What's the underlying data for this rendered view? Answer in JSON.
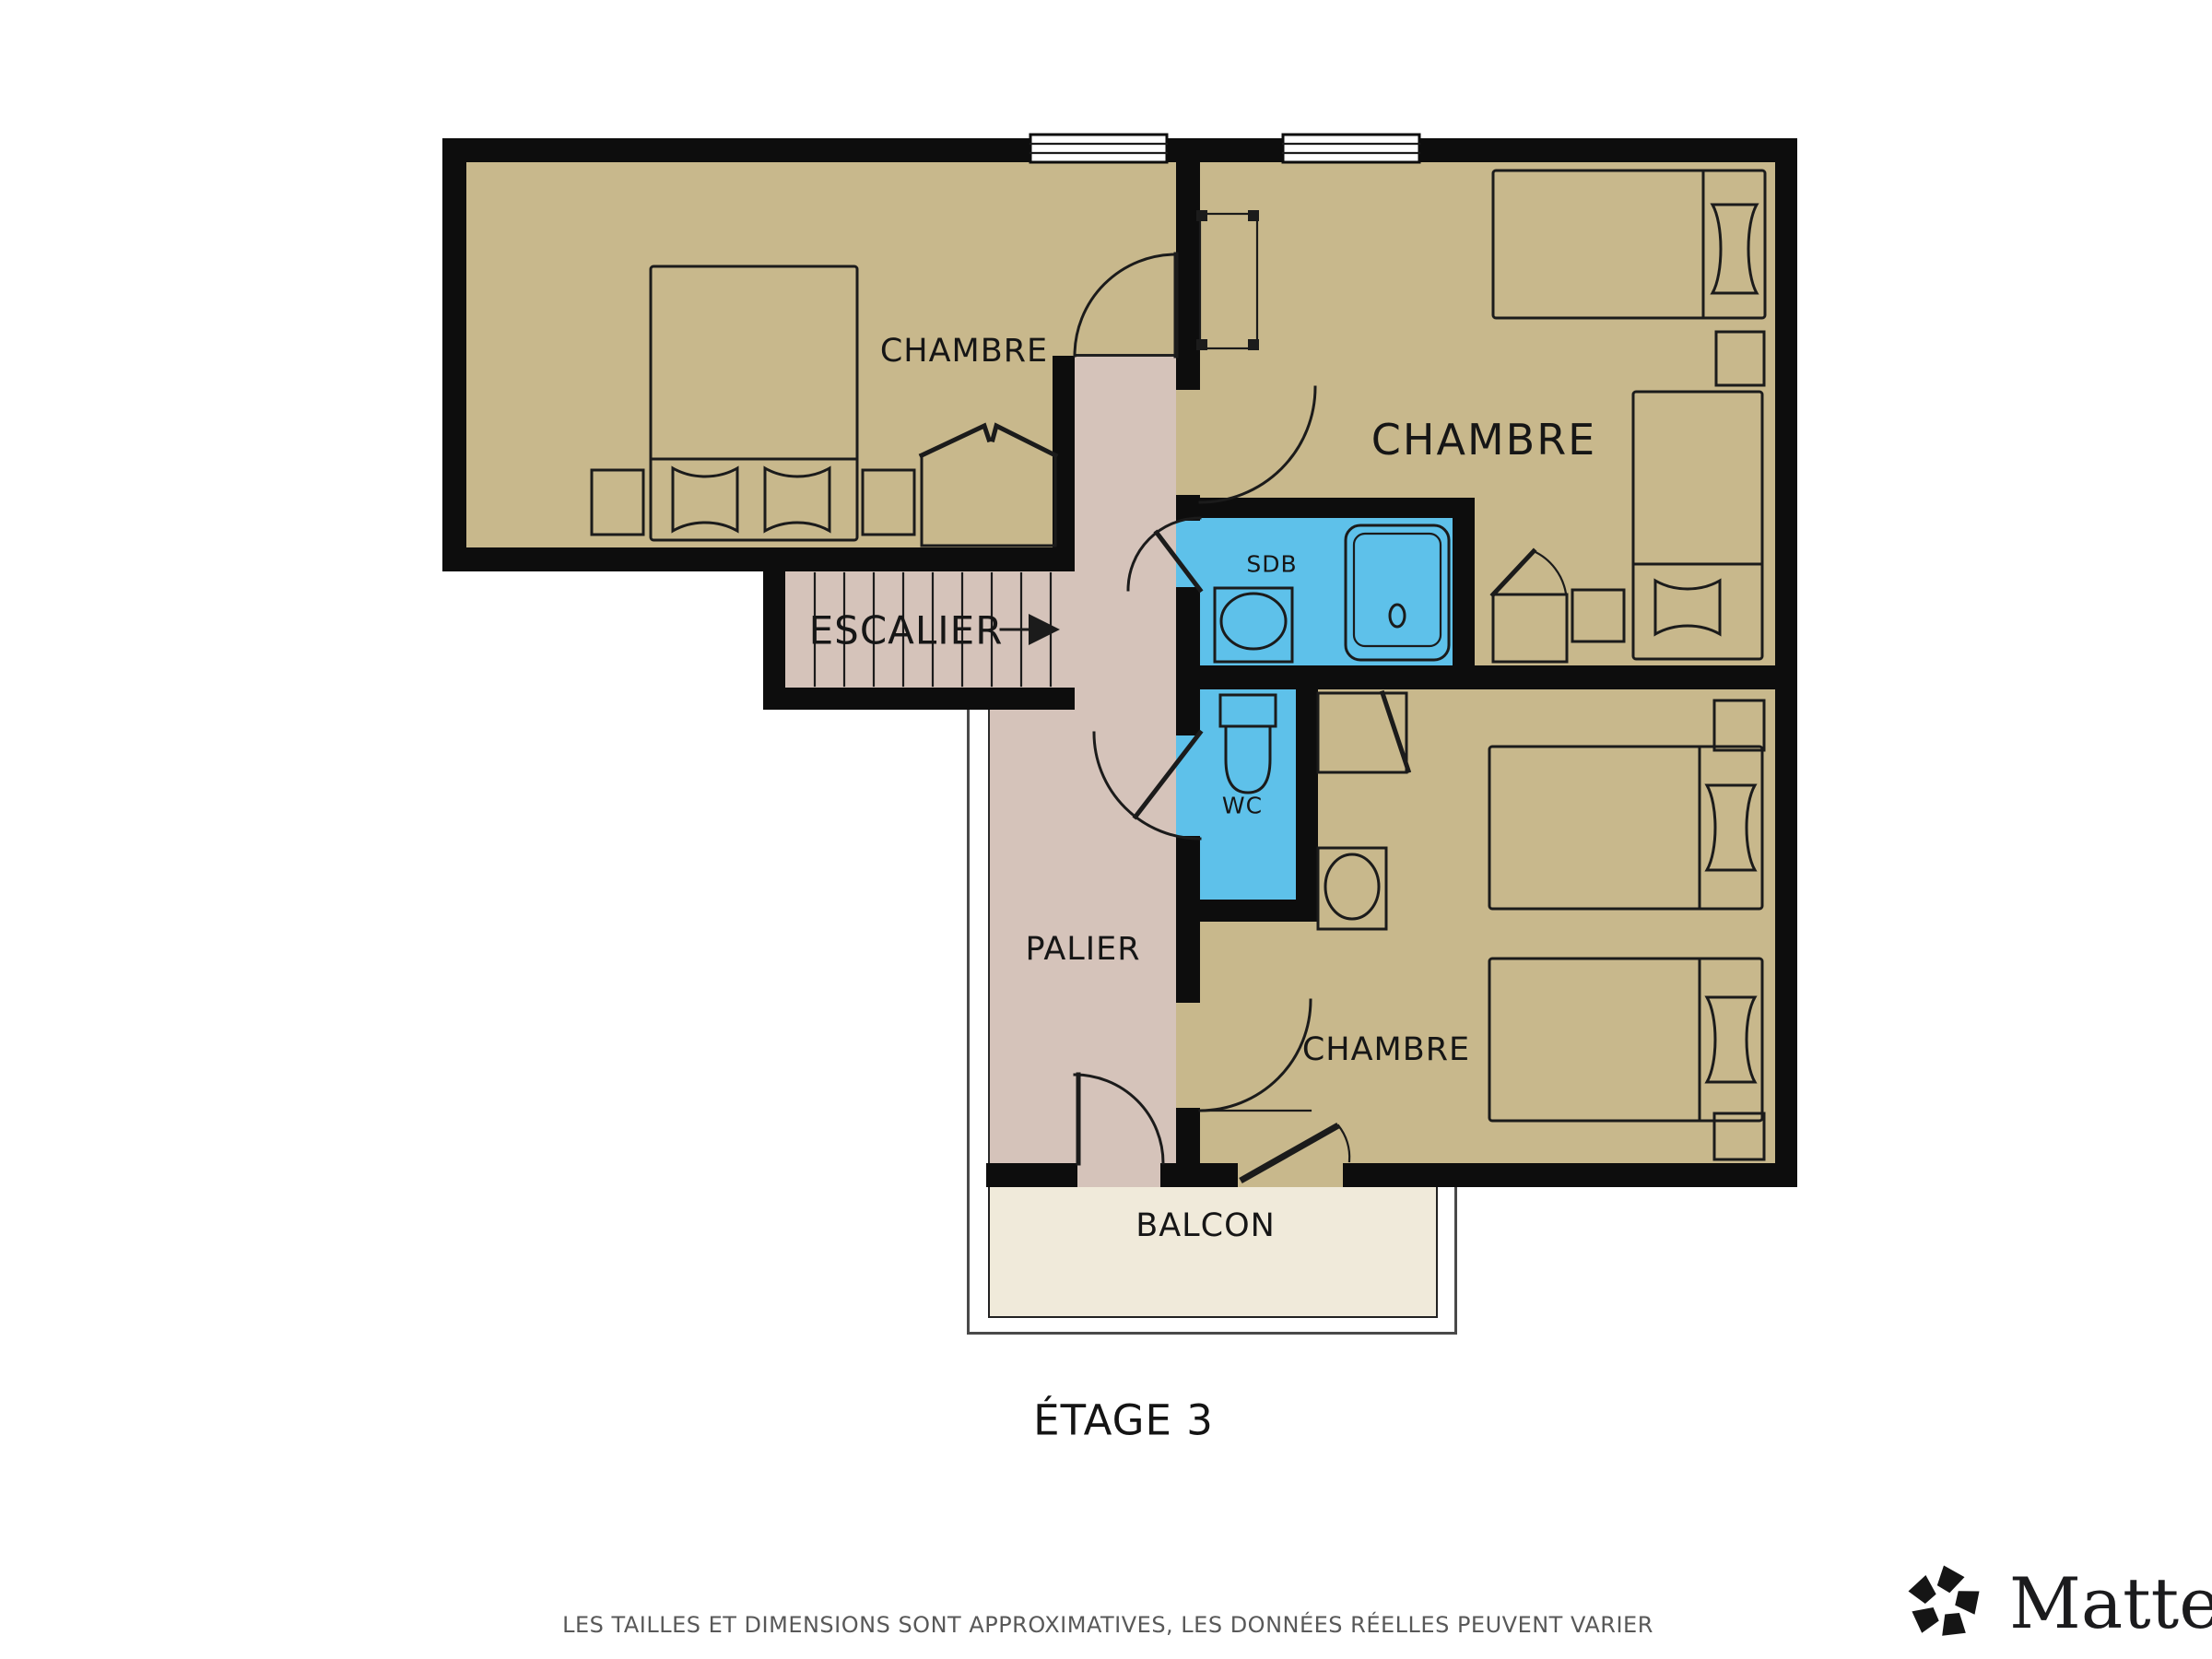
{
  "rooms": {
    "chambre_top_left": {
      "label": "CHAMBRE"
    },
    "chambre_top_right": {
      "label": "CHAMBRE"
    },
    "chambre_bottom": {
      "label": "CHAMBRE"
    },
    "escalier": {
      "label": "ESCALIER"
    },
    "palier": {
      "label": "PALIER"
    },
    "sdb": {
      "label": "SDB"
    },
    "wc": {
      "label": "WC"
    },
    "balcon": {
      "label": "BALCON"
    }
  },
  "footer": {
    "floor_title": "ÉTAGE 3",
    "disclaimer": "LES TAILLES ET DIMENSIONS SONT APPROXIMATIVES, LES DONNÉES RÉELLES PEUVENT VARIER",
    "brand_wordmark": "Matterport"
  },
  "icons": {
    "stairs_direction_arrow": "right-triangle-arrow",
    "matterport_logo": "pinwheel-pentagon-mark"
  },
  "colors": {
    "room": "#C8B88C",
    "hall": "#D5C3BA",
    "wet": "#5EC1EA",
    "balcony": "#F0EADA",
    "wall": "#0D0D0D",
    "line": "#1B1B1B",
    "muted": "#585858"
  }
}
